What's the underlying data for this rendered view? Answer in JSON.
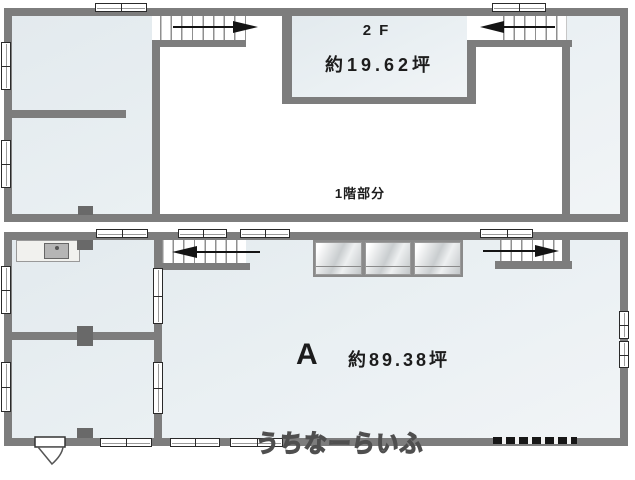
{
  "colors": {
    "wall": "#7d7d7d",
    "fill_light": "#eaf0f3",
    "pillar": "#696969",
    "arrow": "#141414",
    "text": "#1c1c1c",
    "window_border": "#2a2a2a",
    "tread": "#8f8f8f",
    "watermark_stroke": "#4f4f4f"
  },
  "upper_plan": {
    "floor_label": "2F",
    "floor_area": "約19.62坪",
    "void_label": "1階部分"
  },
  "lower_plan": {
    "unit_label": "A",
    "unit_area": "約89.38坪"
  },
  "watermark": {
    "text": "うちなーらいふ"
  },
  "icons": {
    "stair_arrow_right": "black-arrow-right",
    "stair_arrow_left": "black-arrow-left",
    "entrance_door": "door-swing-shape",
    "kitchen_sink": "sink-rect"
  }
}
